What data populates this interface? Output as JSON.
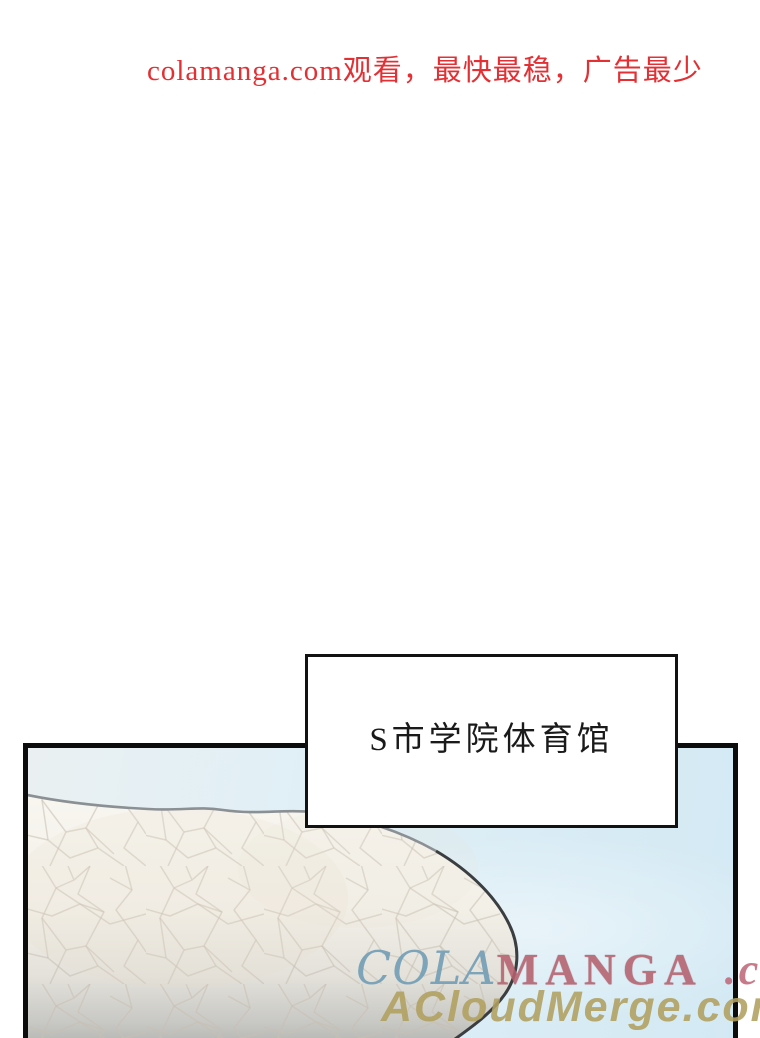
{
  "ad_banner": {
    "text": "colamanga.com观看，最快最稳，广告最少",
    "color": "#e23034"
  },
  "caption_box": {
    "text": "S市学院体育馆",
    "border_color": "#121212",
    "background": "#ffffff"
  },
  "panel": {
    "description": "comic panel showing the white dome roof of a gymnasium against a pale blue sky",
    "border_color": "#0c0c0c",
    "sky_color_left": "#eaf0f2",
    "sky_color_right": "#d3e9f4",
    "dome_fill": "#f6f3ec",
    "dome_bottom_shade": "#b5b6b4",
    "dome_outline_light": "#8b9094",
    "dome_outline_dark": "#3a3e41",
    "crackle_color": "#c6bfb0"
  },
  "watermarks": {
    "line1": {
      "part1": "COLA",
      "part1_color": "#6f9cb4",
      "part2": "MANGA",
      "part2_color": "#b5606e",
      "part3": ".com",
      "part3_color": "#c0697a"
    },
    "line2": {
      "text": "ACloudMerge.com",
      "color": "#b1a05f"
    }
  }
}
